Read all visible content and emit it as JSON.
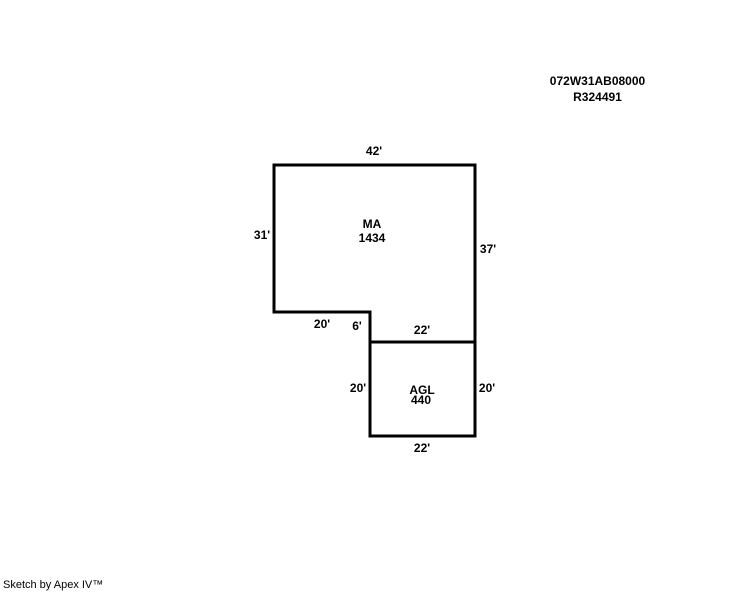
{
  "colors": {
    "background": "#ffffff",
    "line": "#000000",
    "text": "#000000"
  },
  "ref_numbers": {
    "line1": "072W31AB08000",
    "line2": "R324491"
  },
  "sketch": {
    "line_color": "#000000",
    "areas": {
      "ma": {
        "code": "MA",
        "area": "1434"
      },
      "agl": {
        "code": "AGL",
        "area": "440"
      }
    },
    "dimensions": {
      "ma_top": "42'",
      "ma_left": "31'",
      "ma_right": "37'",
      "ma_notch_bottom": "20'",
      "ma_notch_side": "6'",
      "agl_top": "22'",
      "agl_left": "20'",
      "agl_right": "20'",
      "agl_bottom": "22'"
    }
  },
  "footer": {
    "credit": "Sketch by Apex IV™"
  }
}
